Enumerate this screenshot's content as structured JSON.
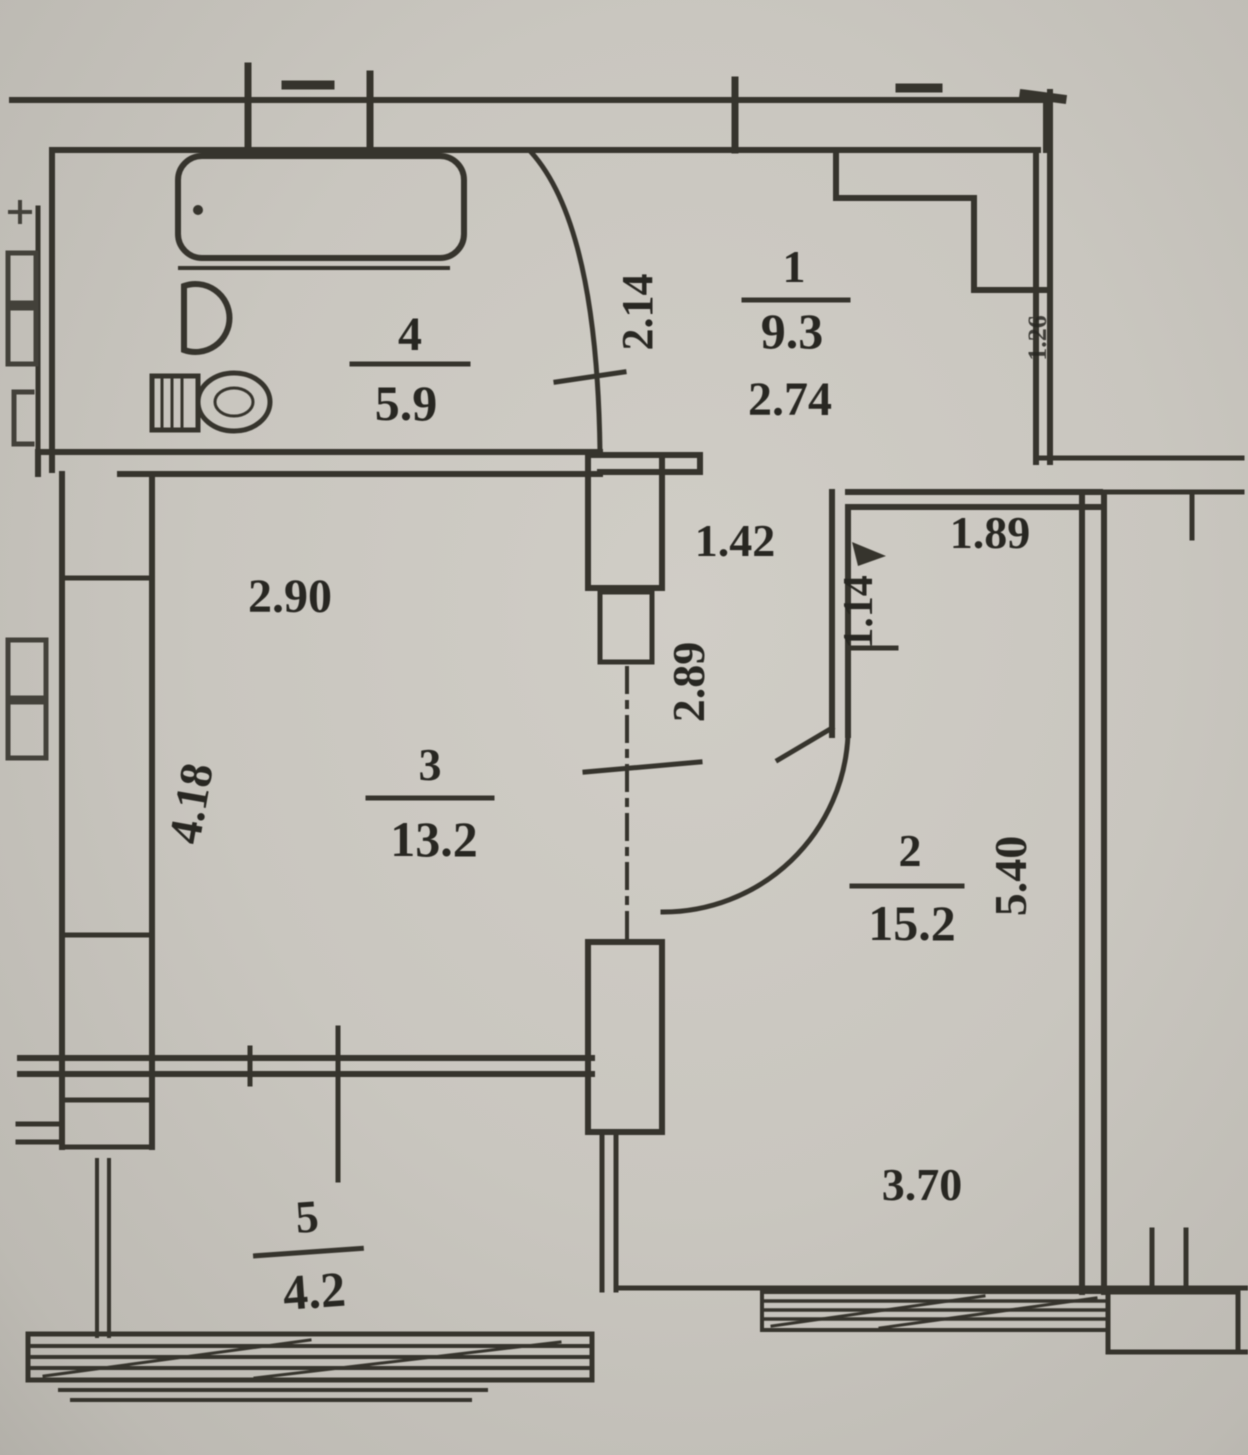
{
  "plan_labels": {
    "rooms": [
      {
        "name": "hallway",
        "number": "1",
        "area": "9.3"
      },
      {
        "name": "room-2",
        "number": "2",
        "area": "15.2"
      },
      {
        "name": "living-room",
        "number": "3",
        "area": "13.2"
      },
      {
        "name": "bathroom",
        "number": "4",
        "area": "5.9"
      },
      {
        "name": "balcony",
        "number": "5",
        "area": "4.2"
      }
    ],
    "dimensions": {
      "hall_width": "2.74",
      "bath_door": "2.14",
      "corridor_opening": "1.42",
      "corridor_length": "2.89",
      "living_width": "2.90",
      "living_depth": "4.18",
      "room2_niche": "1.14",
      "room2_top": "1.89",
      "room2_depth": "5.40",
      "room2_width": "3.70",
      "side_vertical": "1.26"
    }
  }
}
